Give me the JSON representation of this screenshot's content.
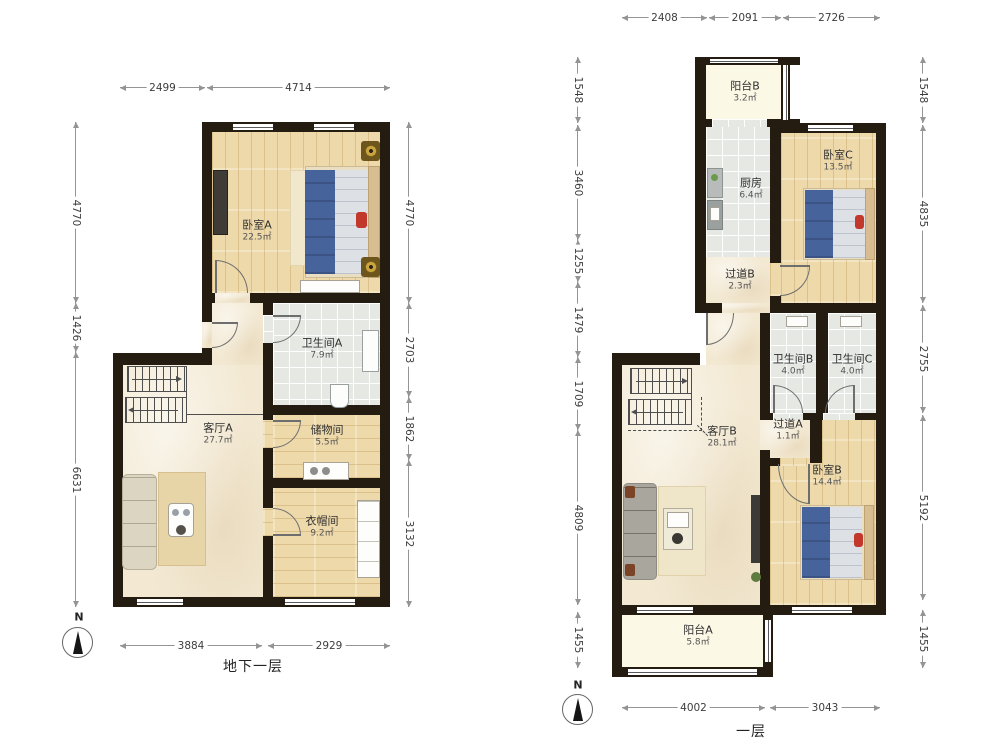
{
  "document": {
    "type": "floorplan",
    "units_note": "mm",
    "area_unit": "㎡"
  },
  "colors": {
    "wall": "#241b11",
    "wood": "#eed9ab",
    "marble": "#f3e9d3",
    "tile": "#e6e8e4",
    "balcony": "#fbf8e6",
    "bed_blanket": "#47639c",
    "accent_red": "#c2392b",
    "dim_line": "#949494"
  },
  "floors": [
    {
      "id": "basement",
      "title": "地下一层",
      "compass_label": "N",
      "rooms": [
        {
          "name": "卧室A",
          "area": "22.5㎡"
        },
        {
          "name": "卫生间A",
          "area": "7.9㎡"
        },
        {
          "name": "客厅A",
          "area": "27.7㎡"
        },
        {
          "name": "储物间",
          "area": "5.5㎡"
        },
        {
          "name": "衣帽间",
          "area": "9.2㎡"
        }
      ],
      "dims": {
        "top": [
          "2499",
          "4714"
        ],
        "bottom": [
          "3884",
          "2929"
        ],
        "left": [
          "4770",
          "1426",
          "6631"
        ],
        "right": [
          "4770",
          "2703",
          "1862",
          "3132"
        ]
      }
    },
    {
      "id": "first-floor",
      "title": "一层",
      "compass_label": "N",
      "rooms": [
        {
          "name": "阳台B",
          "area": "3.2㎡"
        },
        {
          "name": "厨房",
          "area": "6.4㎡"
        },
        {
          "name": "卧室C",
          "area": "13.5㎡"
        },
        {
          "name": "过道B",
          "area": "2.3㎡"
        },
        {
          "name": "卫生间B",
          "area": "4.0㎡"
        },
        {
          "name": "卫生间C",
          "area": "4.0㎡"
        },
        {
          "name": "过道A",
          "area": "1.1㎡"
        },
        {
          "name": "客厅B",
          "area": "28.1㎡"
        },
        {
          "name": "卧室B",
          "area": "14.4㎡"
        },
        {
          "name": "阳台A",
          "area": "5.8㎡"
        }
      ],
      "dims": {
        "top": [
          "2408",
          "2091",
          "2726"
        ],
        "bottom": [
          "4002",
          "3043"
        ],
        "left": [
          "1548",
          "3460",
          "1255",
          "1479",
          "1709",
          "4809",
          "1455"
        ],
        "right": [
          "1548",
          "4835",
          "2755",
          "5192",
          "1455"
        ]
      }
    }
  ]
}
